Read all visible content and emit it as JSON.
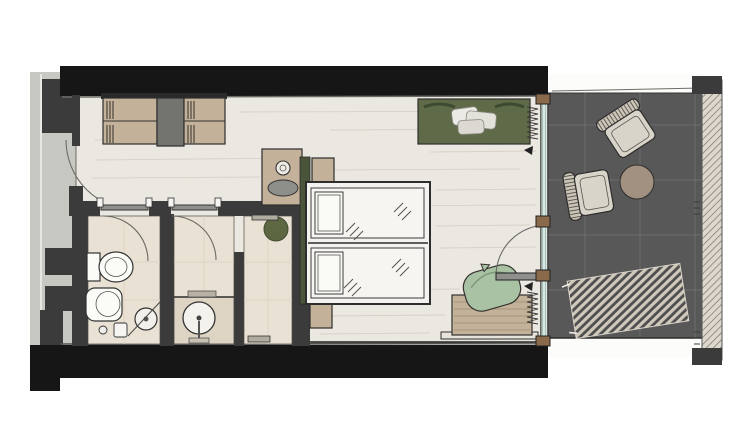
{
  "scene": {
    "type": "hand-sketched hotel room floor plan, top view",
    "rooms": [
      "corridor",
      "entry",
      "wc",
      "bathroom",
      "shower",
      "bedroom",
      "terrace"
    ],
    "furniture": [
      "wardrobe",
      "minibar-cabinet",
      "toilet",
      "bidet",
      "round-washbasin",
      "vanity-basin",
      "rain-shower-head",
      "double-bed",
      "pillows",
      "headboard",
      "nightstands",
      "daybed-sofa",
      "desk",
      "desk-armchair",
      "terrace-chairs",
      "terrace-table",
      "sun-lounger"
    ],
    "doors": [
      "entrance-door",
      "wc-door",
      "bathroom-door",
      "terrace-door"
    ]
  },
  "colors": {
    "page": "#ffffff",
    "corridor": "#c7c8c2",
    "wall_black": "#161616",
    "wall_dark": "#3b3b3b",
    "floor_wood": "#ebe7e1",
    "floor_bath": "#e9e1d3",
    "counter_bath": "#ddd4c4",
    "furniture_tan": "#c3b199",
    "cabinet_gray": "#737370",
    "green_headboard": "#49543a",
    "green_daybed": "#5f6b48",
    "green_olive": "#5d6742",
    "green_sage": "#a9c2a4",
    "terrace_floor": "#585858",
    "terrace_grid": "#6d6d6d",
    "chair_beige": "#d9d4c9",
    "chair_back": "#cbc5b8",
    "table_tan": "#a29180",
    "lounger_slat": "#cfc9bb",
    "lounger_dark": "#4e4e4e",
    "balustrade_bg": "#dcd8ce",
    "balustrade_line": "#86806f",
    "mullion_bronze": "#8a6a4a",
    "glass": "#a5c2ba",
    "fixture_white": "#fbfbf8",
    "door_leaf": "#8f8f8b",
    "band_white": "#fcfcfa",
    "tray_gray": "#8e8e8a",
    "cushion_light": "#eceae4"
  }
}
